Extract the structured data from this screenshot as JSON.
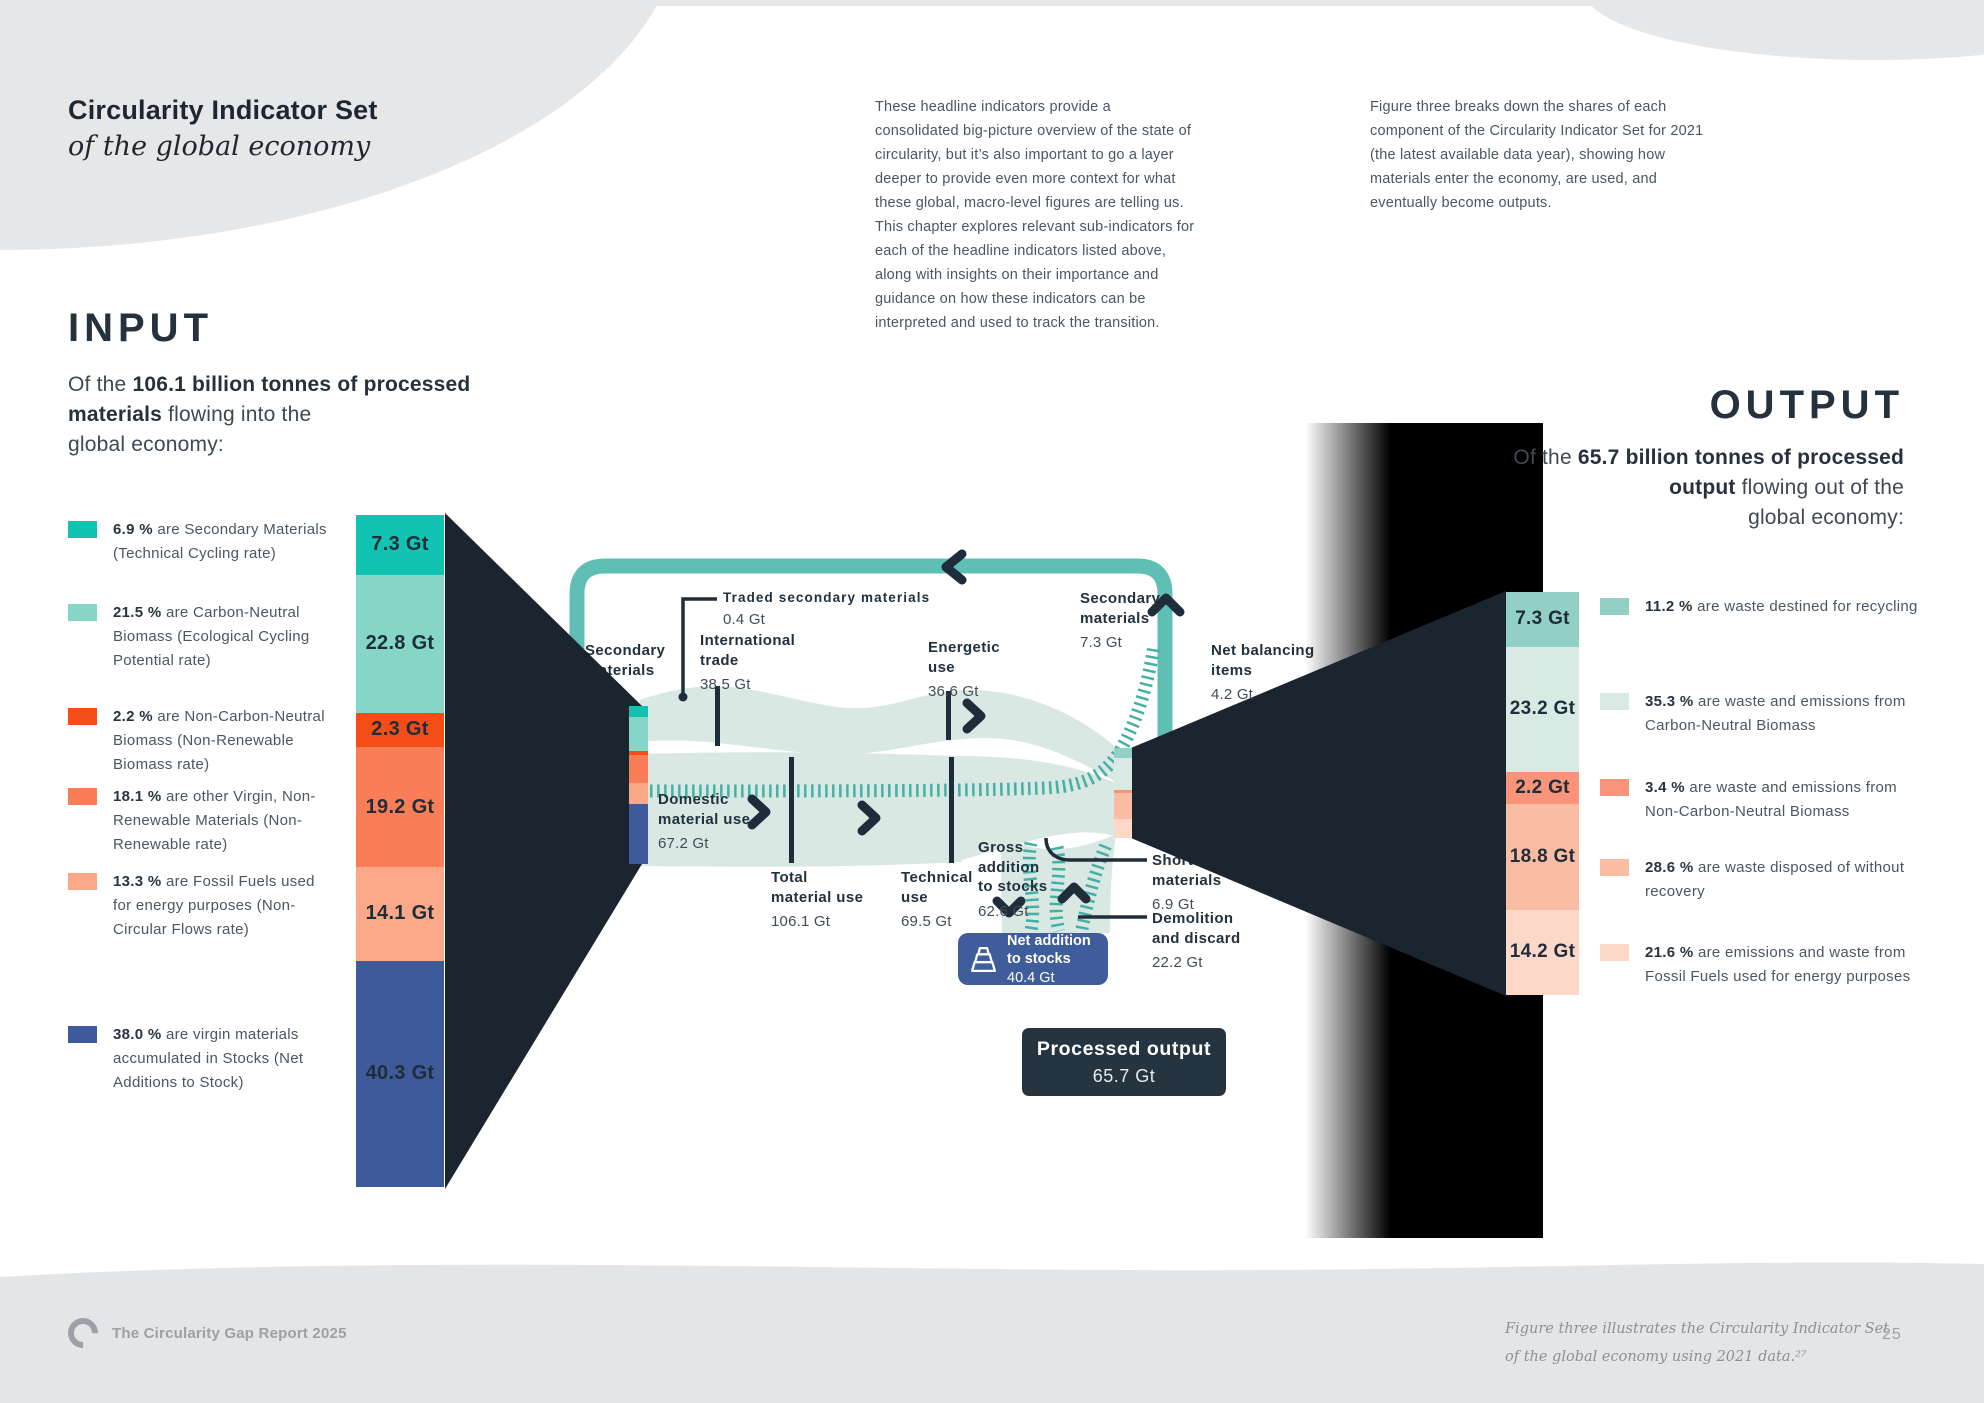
{
  "header": {
    "title_bold": "Circularity Indicator Set",
    "title_italic": "of the global economy",
    "intro_col1": "These headline indicators provide a consolidated big-picture overview of the state of circularity, but it’s also important to go a layer deeper to provide even more context for what these global, macro-level figures are telling us. This chapter explores relevant sub-indicators for each of the headline indicators listed above, along with insights on their importance and guidance on how these indicators can be interpreted and used to track the transition.",
    "intro_col2": "Figure three breaks down the shares of each component of the Circularity Indicator Set for 2021 (the latest available data year), showing how materials enter the economy, are used, and eventually become outputs."
  },
  "input": {
    "heading": "INPUT",
    "subtitle_prefix": "Of the ",
    "subtitle_bold": "106.1 billion tonnes of processed materials",
    "subtitle_rest": " flowing into the\nglobal economy:",
    "legend": [
      {
        "pct": "6.9 %",
        "text": "are Secondary Materials (Technical Cycling rate)",
        "color": "#11C3B1"
      },
      {
        "pct": "21.5 %",
        "text": "are Carbon-Neutral Biomass (Ecological Cycling Potential rate)",
        "color": "#86D6C8"
      },
      {
        "pct": "2.2 %",
        "text": "are Non-Carbon-Neutral Biomass (Non-Renewable Biomass rate)",
        "color": "#F44D17"
      },
      {
        "pct": "18.1 %",
        "text": "are other Virgin, Non-Renewable Materials (Non-Renewable rate)",
        "color": "#F97E58"
      },
      {
        "pct": "13.3 %",
        "text": "are Fossil Fuels used for energy purposes (Non-Circular Flows rate)",
        "color": "#FAA888"
      },
      {
        "pct": "38.0 %",
        "text": "are virgin materials accumulated in Stocks (Net Additions to Stock)",
        "color": "#3E5A9A"
      }
    ],
    "bar": [
      {
        "label": "7.3 Gt",
        "gt": 7.3,
        "color": "#11C3B1"
      },
      {
        "label": "22.8 Gt",
        "gt": 22.8,
        "color": "#86D6C8"
      },
      {
        "label": "2.3 Gt",
        "gt": 2.3,
        "color": "#F44D17"
      },
      {
        "label": "19.2 Gt",
        "gt": 19.2,
        "color": "#F97E58"
      },
      {
        "label": "14.1 Gt",
        "gt": 14.1,
        "color": "#FAA888"
      },
      {
        "label": "40.3 Gt",
        "gt": 40.3,
        "color": "#3E5A9A"
      }
    ]
  },
  "output": {
    "heading": "OUTPUT",
    "subtitle_prefix": "Of the ",
    "subtitle_bold": "65.7 billion tonnes of processed output",
    "subtitle_rest": " flowing out of the\nglobal economy:",
    "legend": [
      {
        "pct": "11.2 %",
        "text": "are waste destined for recycling",
        "color": "#92CFC4"
      },
      {
        "pct": "35.3 %",
        "text": "are waste and emissions from Carbon-Neutral Biomass",
        "color": "#D9EAE5"
      },
      {
        "pct": "3.4 %",
        "text": "are waste and emissions from Non-Carbon-Neutral Biomass",
        "color": "#F9937A"
      },
      {
        "pct": "28.6 %",
        "text": "are waste disposed of without recovery",
        "color": "#FBBCA4"
      },
      {
        "pct": "21.6 %",
        "text": "are emissions and waste from Fossil Fuels used for energy purposes",
        "color": "#FDD8C9"
      }
    ],
    "bar": [
      {
        "label": "7.3 Gt",
        "gt": 7.3,
        "color": "#92CFC4"
      },
      {
        "label": "23.2 Gt",
        "gt": 23.2,
        "color": "#D9EAE5"
      },
      {
        "label": "2.2 Gt",
        "gt": 2.2,
        "color": "#F9937A"
      },
      {
        "label": "18.8 Gt",
        "gt": 18.8,
        "color": "#FBBCA4"
      },
      {
        "label": "14.2 Gt",
        "gt": 14.2,
        "color": "#FDD8C9"
      }
    ]
  },
  "sankey": {
    "labels": {
      "secondary_left": {
        "label": "Secondary\nmaterials",
        "value": "7.3 Gt"
      },
      "traded": {
        "label": "Traded secondary materials",
        "value": "0.4 Gt"
      },
      "international_trade": {
        "label": "International\ntrade",
        "value": "38.5 Gt"
      },
      "energetic_use": {
        "label": "Energetic\nuse",
        "value": "36.6 Gt"
      },
      "secondary_top": {
        "label": "Secondary\nmaterials",
        "value": "7.3 Gt"
      },
      "net_balancing": {
        "label": "Net balancing\nitems",
        "value": "4.2 Gt"
      },
      "domestic": {
        "label": "Domestic\nmaterial use",
        "value": "67.2 Gt"
      },
      "total": {
        "label": "Total\nmaterial use",
        "value": "106.1 Gt"
      },
      "technical": {
        "label": "Technical\nuse",
        "value": "69.5 Gt"
      },
      "gross_addition": {
        "label": "Gross\naddition\nto stocks",
        "value": "62.6 Gt"
      },
      "short_lived": {
        "label": "Short-lived\nmaterials",
        "value": "6.9 Gt"
      },
      "demolition": {
        "label": "Demolition\nand discard",
        "value": "22.2 Gt"
      }
    },
    "badges": {
      "net_addition": {
        "label": "Net addition\nto stocks",
        "value": "40.4 Gt",
        "color": "#3F5C9B"
      },
      "processed_output": {
        "label": "Processed output",
        "value": "65.7 Gt",
        "color": "#263440"
      }
    }
  },
  "palette": {
    "flow": "#D9E8E3",
    "loop": "#5FBFB4",
    "hatch": "#45B1A6",
    "funnel": "#1B2530",
    "ink": "#1F2C39"
  },
  "footer": {
    "brand": "The Circularity Gap Report 2025",
    "caption": "Figure three illustrates the Circularity Indicator Set\nof the global economy using 2021 data.²⁷",
    "page": "25"
  },
  "chart_data": [
    {
      "type": "bar",
      "title": "INPUT — composition of 106.1 Gt processed materials (2021)",
      "categories": [
        "Secondary Materials (Technical Cycling rate)",
        "Carbon-Neutral Biomass (Ecological Cycling Potential rate)",
        "Non-Carbon-Neutral Biomass (Non-Renewable Biomass rate)",
        "Other Virgin, Non-Renewable Materials (Non-Renewable rate)",
        "Fossil Fuels used for energy purposes (Non-Circular Flows rate)",
        "Virgin materials accumulated in Stocks (Net Additions to Stock)"
      ],
      "values_gt": [
        7.3,
        22.8,
        2.3,
        19.2,
        14.1,
        40.3
      ],
      "values_pct": [
        6.9,
        21.5,
        2.2,
        18.1,
        13.3,
        38.0
      ],
      "ylabel": "Gt"
    },
    {
      "type": "bar",
      "title": "OUTPUT — composition of 65.7 Gt processed output (2021)",
      "categories": [
        "Waste destined for recycling",
        "Waste and emissions from Carbon-Neutral Biomass",
        "Waste and emissions from Non-Carbon-Neutral Biomass",
        "Waste disposed of without recovery",
        "Emissions and waste from Fossil Fuels used for energy purposes"
      ],
      "values_gt": [
        7.3,
        23.2,
        2.2,
        18.8,
        14.2
      ],
      "values_pct": [
        11.2,
        35.3,
        3.4,
        28.6,
        21.6
      ],
      "ylabel": "Gt"
    },
    {
      "type": "sankey",
      "title": "Material flows of the global economy, 2021 (Gt)",
      "flows_gt": {
        "Secondary materials (input)": 7.3,
        "Traded secondary materials": 0.4,
        "International trade": 38.5,
        "Domestic material use": 67.2,
        "Total material use": 106.1,
        "Energetic use": 36.6,
        "Technical use": 69.5,
        "Gross addition to stocks": 62.6,
        "Net addition to stocks": 40.4,
        "Demolition and discard": 22.2,
        "Short-lived materials": 6.9,
        "Secondary materials (recycled)": 7.3,
        "Net balancing items": 4.2,
        "Processed output": 65.7
      }
    }
  ]
}
